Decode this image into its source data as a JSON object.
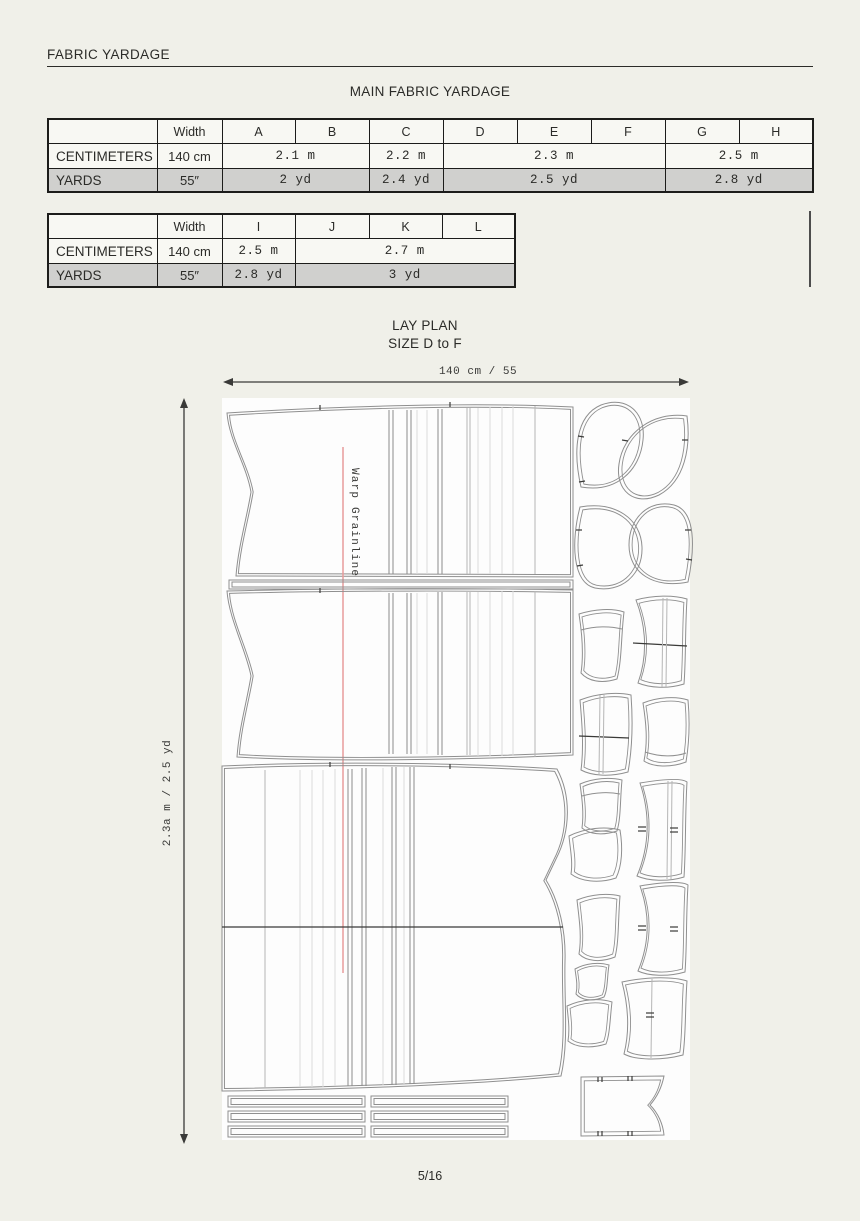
{
  "page": {
    "title": "FABRIC YARDAGE",
    "page_number": "5/16"
  },
  "main_table": {
    "title": "MAIN FABRIC YARDAGE",
    "width_header": "Width",
    "size_headers": [
      "A",
      "B",
      "C",
      "D",
      "E",
      "F",
      "G",
      "H"
    ],
    "centimeters": {
      "label": "CENTIMETERS",
      "width": "140 cm",
      "ab": "2.1 m",
      "c": "2.2 m",
      "def": "2.3 m",
      "gh": "2.5 m"
    },
    "yards": {
      "label": "YARDS",
      "width": "55″",
      "ab": "2 yd",
      "c": "2.4 yd",
      "def": "2.5 yd",
      "gh": "2.8 yd"
    }
  },
  "second_table": {
    "width_header": "Width",
    "size_headers": [
      "I",
      "J",
      "K",
      "L"
    ],
    "centimeters": {
      "label": "CENTIMETERS",
      "width": "140 cm",
      "i": "2.5 m",
      "jkl": "2.7 m"
    },
    "yards": {
      "label": "YARDS",
      "width": "55″",
      "i": "2.8 yd",
      "jkl": "3 yd"
    }
  },
  "lay_plan": {
    "title": "LAY PLAN",
    "subtitle": "SIZE D to F",
    "fabric_width_label": "140 cm / 55",
    "fabric_length_label": "2.3a m / 2.5 yd",
    "grainline_label": "Warp Grainline"
  },
  "colors": {
    "page_background": "#f0f0e9",
    "fabric_background": "#fdfdfd",
    "shaded_row": "#d0d0ce",
    "grainline_red": "#e89c9c",
    "pattern_outline": "#8f8f8f"
  }
}
